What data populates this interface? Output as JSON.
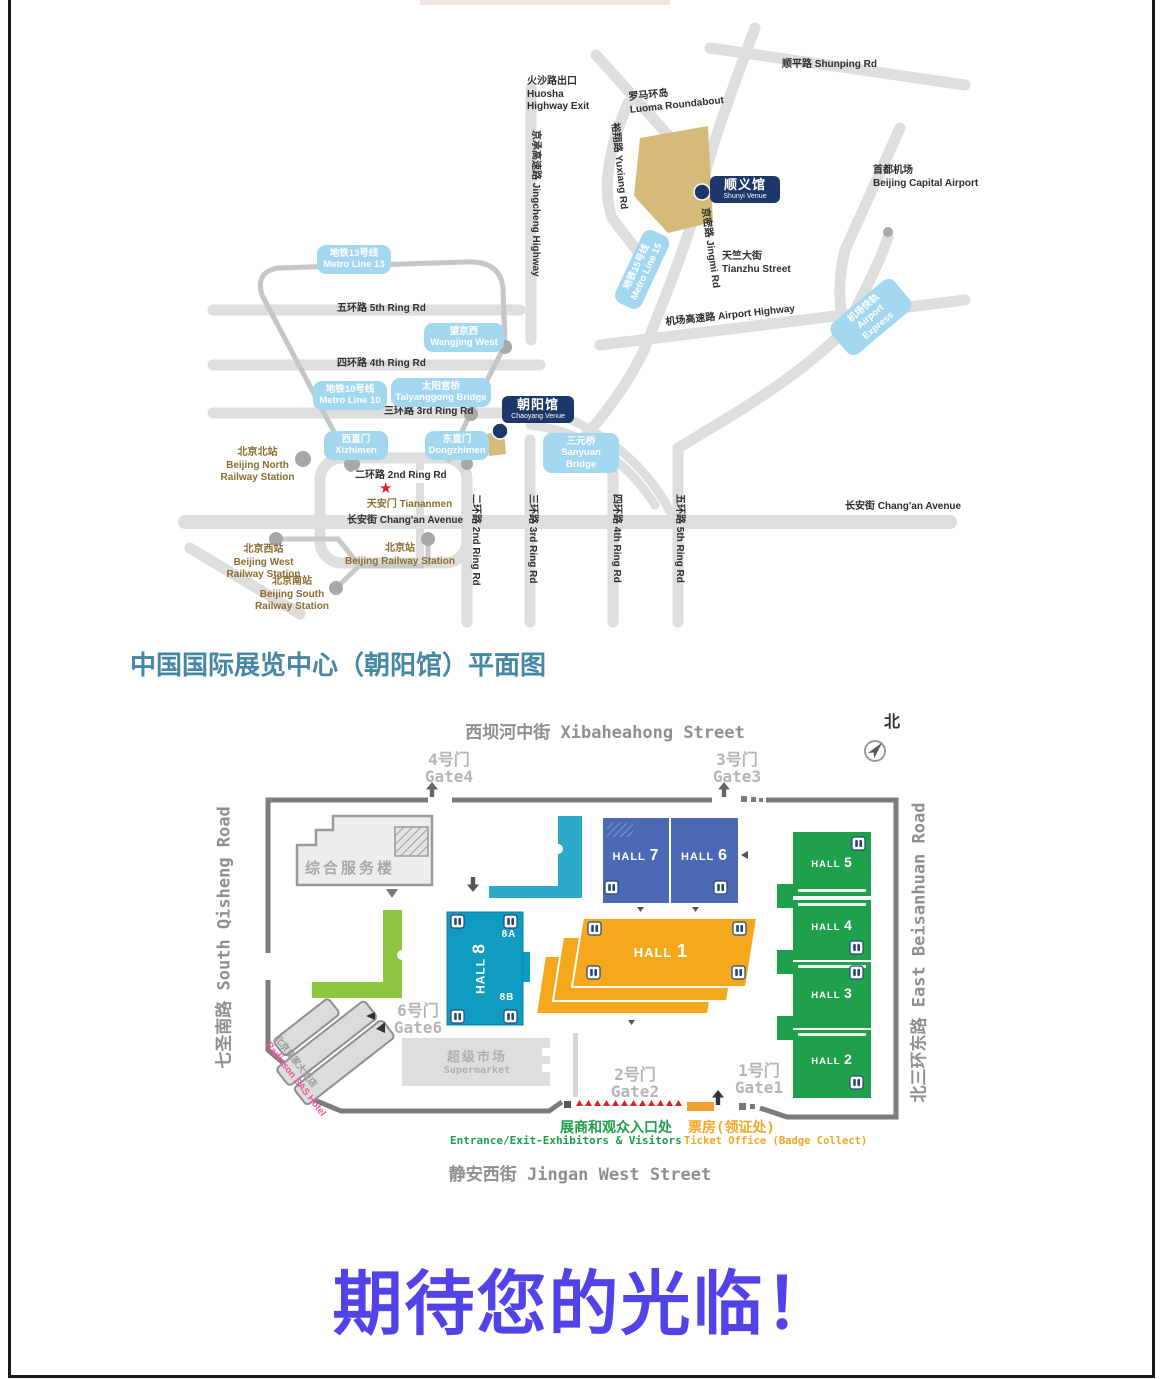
{
  "transit_map": {
    "roads": {
      "shunping": "顺平路  Shunping Rd",
      "huosha_exit": "火沙路出口\nHuosha\nHighway Exit",
      "luoma": "罗马环岛\nLuoma Roundabout",
      "yuxiang": "裕翔路 Yuxiang Rd",
      "jingcheng": "京承高速路 Jingcheng Highway",
      "jingmi": "京密路 Jingmi Rd",
      "capital_airport": "首都机场\nBeijing Capital Airport",
      "tianzhu": "天竺大街\nTianzhu Street",
      "airport_highway": "机场高速路  Airport Highway",
      "ring5": "五环路  5th Ring Rd",
      "ring4": "四环路  4th Ring Rd",
      "ring3": "三环路  3rd Ring Rd",
      "ring2": "二环路  2nd Ring Rd",
      "changan_center": "长安街  Chang'an Avenue",
      "changan_right": "长安街  Chang'an Avenue",
      "ring2_v": "二环路 2nd Ring Rd",
      "ring3_v": "三环路 3rd Ring Rd",
      "ring4_v": "四环路 4th Ring Rd",
      "ring5_v": "五环路 5th Ring Rd"
    },
    "badges": {
      "metro13": "地铁13号线\nMetro Line 13",
      "metro10": "地铁10号线\nMetro Line 10",
      "metro15": "地铁15号线\nMetro Line 15",
      "airport_express": "机场快轨\nAirport\nExpress",
      "wangjing_west": "望京西\nWangjing West",
      "taiyanggong": "太阳宫桥\nTaiyanggong Bridge",
      "xizhimen": "西直门\nXizhimen",
      "dongzhimen": "东直门\nDongzhimen",
      "sanyuan": "三元桥\nSanyuan Bridge"
    },
    "venues": {
      "shunyi_zh": "顺义馆",
      "shunyi_en": "Shunyi Venue",
      "chaoyang_zh": "朝阳馆",
      "chaoyang_en": "Chaoyang Venue"
    },
    "stations": {
      "north": "北京北站\nBeijing North\nRailway Station",
      "west": "北京西站\nBeijing West\nRailway Station",
      "main": "北京站\nBeijing Railway Station",
      "south": "北京南站\nBeijing South\nRailway Station"
    },
    "tiananmen": "天安门  Tiananmen",
    "star": "★"
  },
  "plan_title": "中国国际展览中心（朝阳馆）平面图",
  "floor_plan": {
    "streets": {
      "top": "西坝河中街 Xibaheahong Street",
      "bottom": "静安西街 Jingan West Street",
      "left": "七圣南路 South Qisheng Road",
      "right": "北三环东路 East Beisanhuan Road"
    },
    "north": "北",
    "gates": {
      "gate4": "4号门\nGate4",
      "gate3": "3号门\nGate3",
      "gate6": "6号门\nGate6",
      "gate2": "2号门\nGate2",
      "gate1": "1号门\nGate1"
    },
    "halls": {
      "h7": {
        "name": "HALL",
        "num": "7"
      },
      "h6": {
        "name": "HALL",
        "num": "6"
      },
      "h5": {
        "name": "HALL",
        "num": "5"
      },
      "h4": {
        "name": "HALL",
        "num": "4"
      },
      "h3": {
        "name": "HALL",
        "num": "3"
      },
      "h2": {
        "name": "HALL",
        "num": "2"
      },
      "h1": {
        "name": "HALL",
        "num": "1"
      },
      "h8": {
        "name": "HALL",
        "num": "8"
      },
      "h8a": "8A",
      "h8b": "8B"
    },
    "buildings": {
      "service": "综合服务楼",
      "supermarket_zh": "超级市场",
      "supermarket_en": "Supermarket",
      "hotel_zh": "北京皇家大饭店",
      "hotel_en": "Radisson SAS Hotel"
    },
    "entrance": {
      "zh": "展商和观众入口处",
      "en": "Entrance/Exit-Exhibitors & Visitors"
    },
    "ticket": {
      "zh": "票房(领证处)",
      "en": "Ticket Office (Badge Collect)"
    }
  },
  "footer": {
    "message": "期待您的光临！"
  },
  "colors": {
    "hall_blue": "#4b69b4",
    "hall_green": "#1fa14c",
    "hall_teal": "#0f9cc0",
    "hall_orange": "#f6a81c",
    "building_lime": "#8dc63f",
    "metro_badge_blue": "#a3d7f0",
    "venue_navy": "#1c3768",
    "venue_area_tan": "#d6ba79",
    "title_teal": "#4587a4",
    "footer_blue": "#5143e8",
    "entrance_green": "#1d9e4b",
    "ticket_orange": "#f5a623",
    "hotel_pink": "#f0569a",
    "station_brown": "#8a6c2f",
    "entrance_red": "#e02020"
  }
}
